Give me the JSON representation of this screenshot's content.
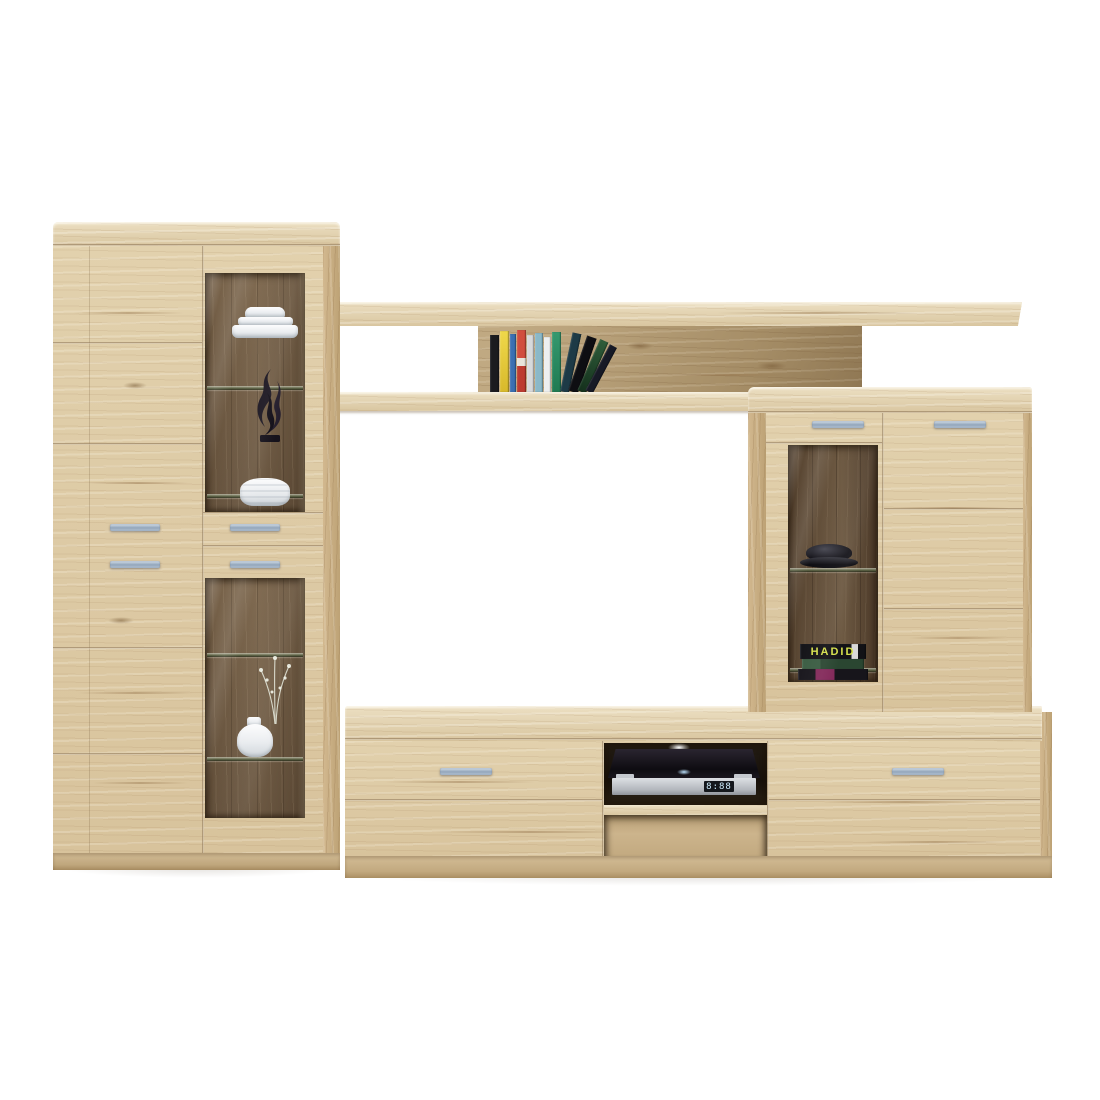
{
  "scene": {
    "background_color": "#ffffff",
    "furniture": "oak-living-room-wall-unit"
  },
  "palette": {
    "wood_face": "#dcc8a2",
    "wood_top": "#e4d5b4",
    "wood_side": "#cdb389",
    "wood_interior": "#77624a",
    "wood_interior_dark": "#5f4c38",
    "handle_silver": "#9db0c4",
    "glass_shelf_edge": "#5e6547",
    "media_player_body": "#17141b",
    "media_player_front": "#c9ccd1"
  },
  "left_cabinet": {
    "display_items_upper": [
      "white-plate-stack",
      "black-flame-sculpture",
      "white-ribbed-bowl"
    ],
    "display_items_lower": [
      "white-vase-with-twigs"
    ]
  },
  "bridge_shelf": {
    "books": [
      {
        "c": "#1b1b1f",
        "w": 9,
        "h": 57
      },
      {
        "c": "linear-gradient(180deg,#efd84a,#d8b92b)",
        "w": 9,
        "h": 61
      },
      {
        "c": "#3a6fb2",
        "w": 6,
        "h": 58
      },
      {
        "c": "linear-gradient(180deg,#d14e3e 0 45%,#e8e4da 45% 58%,#bd3b30 58%)",
        "w": 9,
        "h": 62
      },
      {
        "c": "#d7d9db",
        "w": 7,
        "h": 57
      },
      {
        "c": "#8ab8c8",
        "w": 8,
        "h": 59
      },
      {
        "c": "#edeff0",
        "w": 7,
        "h": 55
      },
      {
        "c": "linear-gradient(180deg,#35996f,#1f7a52)",
        "w": 9,
        "h": 60
      },
      {
        "c": "#1d3a46",
        "w": 9,
        "h": 60,
        "lean": 12
      },
      {
        "c": "#0e0e12",
        "w": 10,
        "h": 58,
        "lean": 19
      },
      {
        "c": "linear-gradient(180deg,#2f5d3a,#14301c)",
        "w": 9,
        "h": 56,
        "lean": 24
      },
      {
        "c": "#171a26",
        "w": 8,
        "h": 52,
        "lean": 28
      }
    ]
  },
  "right_cabinet": {
    "display_items": [
      "black-decor-bowl",
      "architecture-book-stack"
    ],
    "hadid_stack": {
      "spines": [
        {
          "c": "linear-gradient(90deg,#121216 0 78%,#d9d9d9 78% 88%,#121216 88%)",
          "w": 66,
          "h": 15,
          "text": "HADID",
          "tc": "#d5e04c",
          "fs": 11
        },
        {
          "c": "linear-gradient(90deg,#3a5c42 0 30%,#2a4631 30%)",
          "w": 62,
          "h": 10
        },
        {
          "c": "linear-gradient(90deg,#17151b 0 25%,#83295a 25% 52%,#17151b 52%)",
          "w": 70,
          "h": 11
        }
      ]
    }
  },
  "tv_stand": {
    "media_player": {
      "display_text": "8:88",
      "display_color": "#cfeeff"
    }
  }
}
